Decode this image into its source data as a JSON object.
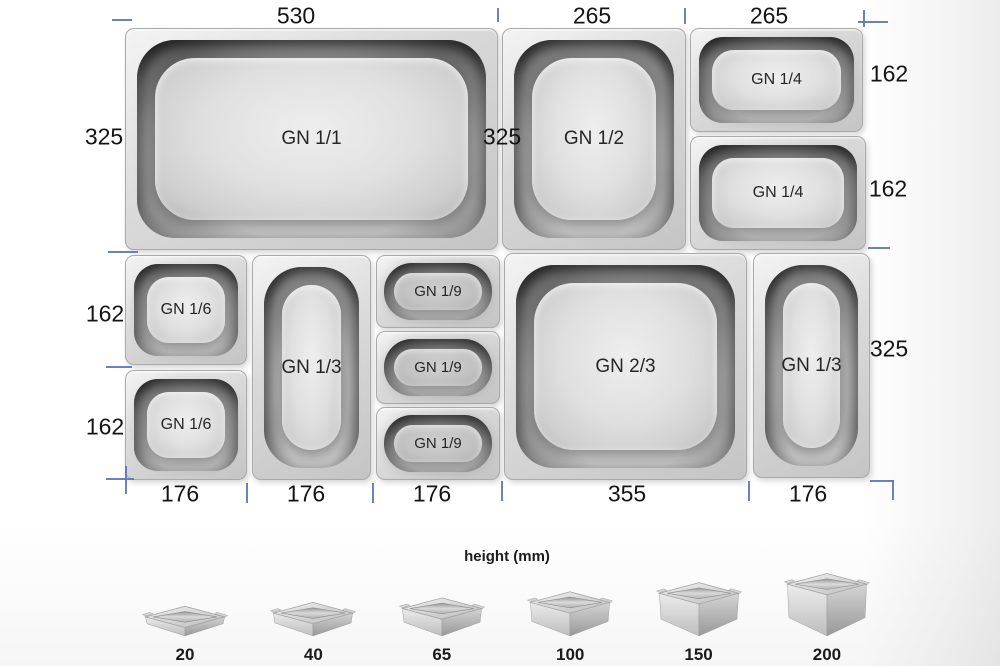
{
  "colors": {
    "tick": "#5b74b8"
  },
  "pans": {
    "gn11": "GN 1/1",
    "gn12": "GN 1/2",
    "gn14a": "GN 1/4",
    "gn14b": "GN 1/4",
    "gn16a": "GN 1/6",
    "gn16b": "GN 1/6",
    "gn13_left": "GN 1/3",
    "gn19a": "GN 1/9",
    "gn19b": "GN 1/9",
    "gn19c": "GN 1/9",
    "gn23": "GN 2/3",
    "gn13_right": "GN 1/3"
  },
  "dimensions": {
    "gn11_width": "530",
    "gn11_height": "325",
    "gn12_width": "265",
    "gn12_height": "325",
    "gn14_width": "265",
    "gn14a_height": "162",
    "gn14b_height": "162",
    "gn16a_height": "162",
    "gn16b_height": "162",
    "gn16_width": "176",
    "gn13_left_width": "176",
    "gn19_width": "176",
    "gn23_width": "355",
    "gn13_right_width": "176",
    "gn13_right_height": "325"
  },
  "height_chart": {
    "title": "height (mm)",
    "items": [
      {
        "label": "20",
        "value": 20
      },
      {
        "label": "40",
        "value": 40
      },
      {
        "label": "65",
        "value": 65
      },
      {
        "label": "100",
        "value": 100
      },
      {
        "label": "150",
        "value": 150
      },
      {
        "label": "200",
        "value": 200
      }
    ]
  }
}
